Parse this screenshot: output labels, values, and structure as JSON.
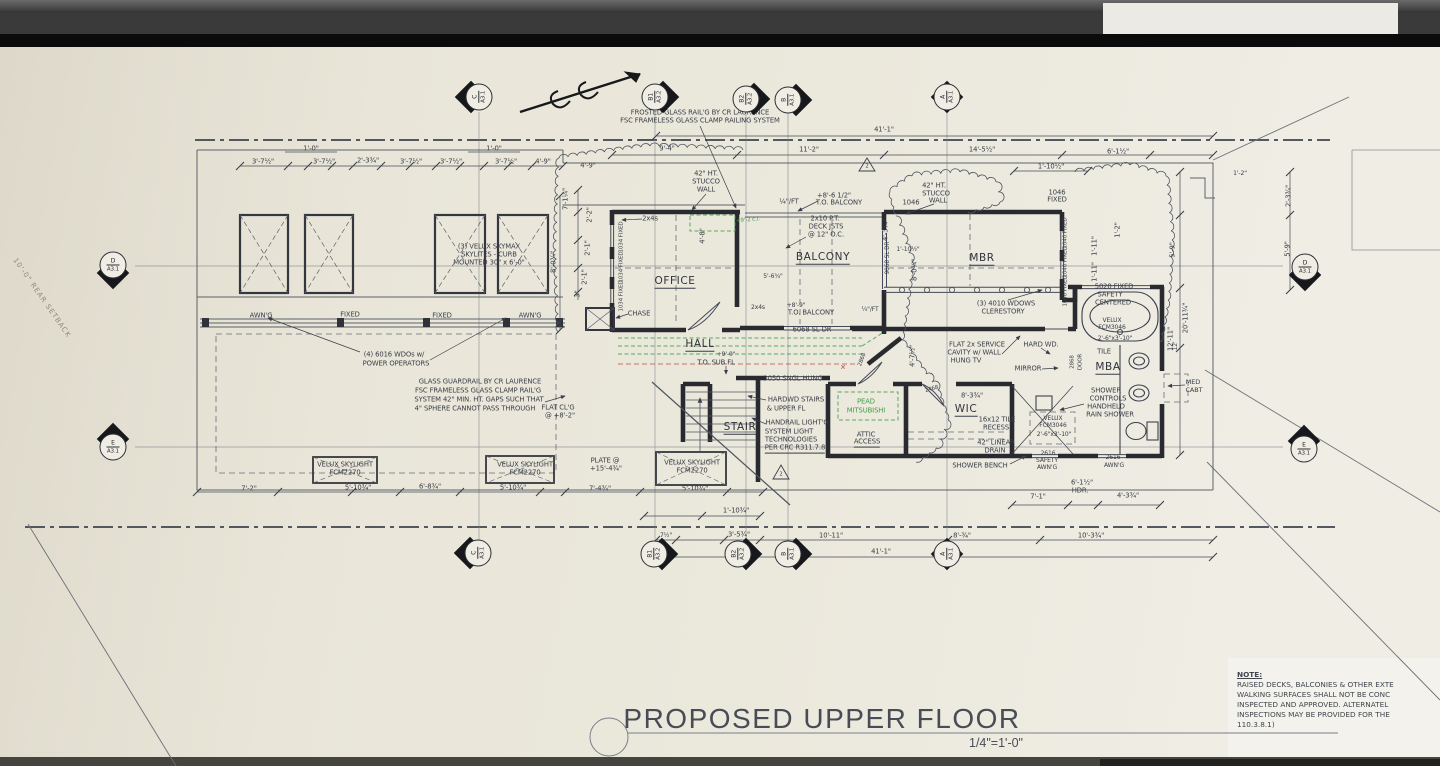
{
  "drawing": {
    "title": "PROPOSED UPPER FLOOR",
    "scale": "1/4\"=1'-0\"",
    "note": {
      "heading": "NOTE:",
      "lines": [
        "RAISED DECKS, BALCONIES & OTHER EXTE",
        "WALKING SURFACES SHALL NOT BE CONC",
        "INSPECTED AND APPROVED. ALTERNATEL",
        "INSPECTIONS MAY BE PROVIDED FOR THE",
        "110.3.8.1)"
      ]
    },
    "setback_label": {
      "t": "10'-0\" REAR SETBACK",
      "x": 42,
      "y": 298,
      "r": 55
    },
    "markers": [
      {
        "id": "C",
        "sheet": "A3.1",
        "x": 479,
        "y": 97,
        "dir": "left"
      },
      {
        "id": "B1",
        "sheet": "A3.2",
        "x": 655,
        "y": 97,
        "dir": "right"
      },
      {
        "id": "B2",
        "sheet": "A3.2",
        "x": 746,
        "y": 99,
        "dir": "right"
      },
      {
        "id": "B",
        "sheet": "A3.1",
        "x": 788,
        "y": 100,
        "dir": "right"
      },
      {
        "id": "A",
        "sheet": "A3.1",
        "x": 947,
        "y": 97,
        "dir": "both"
      },
      {
        "id": "D",
        "sheet": "A3.1",
        "x": 113,
        "y": 265,
        "dir": "down"
      },
      {
        "id": "E",
        "sheet": "A3.1",
        "x": 113,
        "y": 447,
        "dir": "up"
      },
      {
        "id": "D",
        "sheet": "A3.1",
        "x": 1305,
        "y": 267,
        "dir": "down"
      },
      {
        "id": "E",
        "sheet": "A3.1",
        "x": 1304,
        "y": 449,
        "dir": "up"
      },
      {
        "id": "C",
        "sheet": "A3.1",
        "x": 478,
        "y": 553,
        "dir": "left"
      },
      {
        "id": "B1",
        "sheet": "A3.2",
        "x": 654,
        "y": 554,
        "dir": "right"
      },
      {
        "id": "B2",
        "sheet": "A3.2",
        "x": 738,
        "y": 554,
        "dir": "right"
      },
      {
        "id": "B",
        "sheet": "A3.1",
        "x": 788,
        "y": 554,
        "dir": "right"
      },
      {
        "id": "A",
        "sheet": "A3.1",
        "x": 947,
        "y": 554,
        "dir": "both"
      }
    ],
    "labels": [
      {
        "t": "FROSTED GLASS RAIL'G BY CR LAURENCE",
        "x": 700,
        "y": 113
      },
      {
        "t": "FSC FRAMELESS GLASS CLAMP RAILING SYSTEM",
        "x": 700,
        "y": 121
      },
      {
        "t": "41'-1\"",
        "x": 884,
        "y": 130
      },
      {
        "t": "9'-4\"",
        "x": 667,
        "y": 149
      },
      {
        "t": "11'-2\"",
        "x": 809,
        "y": 150
      },
      {
        "t": "14'-5½\"",
        "x": 982,
        "y": 150
      },
      {
        "t": "6'-1½\"",
        "x": 1118,
        "y": 152
      },
      {
        "t": "1'-10½\"",
        "x": 1051,
        "y": 167
      },
      {
        "t": "3'-7½\"",
        "x": 263,
        "y": 162
      },
      {
        "t": "1'-0\"",
        "x": 311,
        "y": 149
      },
      {
        "t": "3'-7½\"",
        "x": 324,
        "y": 162
      },
      {
        "t": "2'-3¾\"",
        "x": 368,
        "y": 161
      },
      {
        "t": "3'-7½\"",
        "x": 411,
        "y": 162
      },
      {
        "t": "3'-7½\"",
        "x": 451,
        "y": 162
      },
      {
        "t": "1'-0\"",
        "x": 494,
        "y": 149
      },
      {
        "t": "3'-7½\"",
        "x": 506,
        "y": 162
      },
      {
        "t": "4'-9\"",
        "x": 543,
        "y": 162
      },
      {
        "t": "4'-9\"",
        "x": 588,
        "y": 166
      },
      {
        "t": "42\" HT.",
        "x": 706,
        "y": 174
      },
      {
        "t": "STUCCO",
        "x": 706,
        "y": 182
      },
      {
        "t": "WALL",
        "x": 706,
        "y": 190
      },
      {
        "t": "+8'-6 1/2\"",
        "x": 834,
        "y": 196
      },
      {
        "t": "T.O. BALCONY",
        "x": 839,
        "y": 203
      },
      {
        "t": "¼\"/FT",
        "x": 789,
        "y": 202
      },
      {
        "t": "2x10 P.T.",
        "x": 825,
        "y": 219
      },
      {
        "t": "DECK JSTS",
        "x": 826,
        "y": 227
      },
      {
        "t": "@ 12\" O.C.",
        "x": 826,
        "y": 235
      },
      {
        "t": "42\" HT.",
        "x": 934,
        "y": 186
      },
      {
        "t": "STUCCO",
        "x": 936,
        "y": 194
      },
      {
        "t": "WALL",
        "x": 938,
        "y": 201
      },
      {
        "t": "1046",
        "x": 911,
        "y": 203
      },
      {
        "t": "2",
        "x": 867,
        "y": 167,
        "fs": 5.2
      },
      {
        "t": "2",
        "x": 781,
        "y": 475,
        "fs": 5.2
      },
      {
        "t": "1046",
        "x": 1057,
        "y": 193
      },
      {
        "t": "FIXED",
        "x": 1057,
        "y": 200
      },
      {
        "t": "2'-3¾\"",
        "x": 1289,
        "y": 196,
        "r": -90
      },
      {
        "t": "5'-9\"",
        "x": 1288,
        "y": 249,
        "r": -90
      },
      {
        "t": "(3) VELUX SKYMAX",
        "x": 489,
        "y": 247
      },
      {
        "t": "SKYLITES - CURB",
        "x": 489,
        "y": 255
      },
      {
        "t": "MOUNTED 30\" x 6'-0\"",
        "x": 489,
        "y": 263
      },
      {
        "t": "7'-1¼\"",
        "x": 566,
        "y": 199,
        "r": -90
      },
      {
        "t": "2'-2\"",
        "x": 590,
        "y": 215,
        "r": -90
      },
      {
        "t": "2'-1\"",
        "x": 588,
        "y": 248,
        "r": -90
      },
      {
        "t": "2'-1\"",
        "x": 585,
        "y": 277,
        "r": -90
      },
      {
        "t": "3\"",
        "x": 578,
        "y": 294,
        "r": -90
      },
      {
        "t": "8'-0¾\"",
        "x": 554,
        "y": 262,
        "r": -90
      },
      {
        "t": "2x4s",
        "x": 650,
        "y": 219
      },
      {
        "t": "1034 FIXED",
        "x": 622,
        "y": 237,
        "r": -90,
        "fs": 5.5
      },
      {
        "t": "1034 FIXED",
        "x": 622,
        "y": 267,
        "r": -90,
        "fs": 5.5
      },
      {
        "t": "1034 FIXED",
        "x": 622,
        "y": 296,
        "r": -90,
        "fs": 5.5
      },
      {
        "t": "4'-8\"",
        "x": 703,
        "y": 236,
        "r": -90
      },
      {
        "t": "OFFICE",
        "x": 675,
        "y": 282,
        "cls": "room u"
      },
      {
        "t": "CHASE",
        "x": 639,
        "y": 314
      },
      {
        "t": "BALCONY",
        "x": 823,
        "y": 258,
        "cls": "room u"
      },
      {
        "t": "MBR",
        "x": 982,
        "y": 259,
        "cls": "room u"
      },
      {
        "t": "9068 SL DR",
        "x": 889,
        "y": 258,
        "r": -90,
        "fs": 5.8
      },
      {
        "t": "1'-10½\"",
        "x": 908,
        "y": 250,
        "fs": 6
      },
      {
        "t": "8'-0¾\"",
        "x": 915,
        "y": 270,
        "r": -90
      },
      {
        "t": "5'-6¾\"",
        "x": 773,
        "y": 277,
        "fs": 6
      },
      {
        "t": "1040 FIXED",
        "x": 1066,
        "y": 233,
        "r": -90,
        "fs": 5.5
      },
      {
        "t": "1040 FIXED",
        "x": 1066,
        "y": 262,
        "r": -90,
        "fs": 5.5
      },
      {
        "t": "1040 FIXED",
        "x": 1066,
        "y": 291,
        "r": -90,
        "fs": 5.5
      },
      {
        "t": "1'-11\"",
        "x": 1095,
        "y": 246,
        "r": -90
      },
      {
        "t": "1'-11\"",
        "x": 1095,
        "y": 272,
        "r": -90
      },
      {
        "t": "1'-2\"",
        "x": 1118,
        "y": 230,
        "r": -90
      },
      {
        "t": "1'-2\"",
        "x": 1240,
        "y": 174,
        "fs": 6
      },
      {
        "t": "(3) 4010 WDOWS",
        "x": 1006,
        "y": 304
      },
      {
        "t": "CLERESTORY",
        "x": 1003,
        "y": 312
      },
      {
        "t": "5020 FIXED",
        "x": 1114,
        "y": 287
      },
      {
        "t": "SAFETY",
        "x": 1110,
        "y": 295
      },
      {
        "t": "CENTERED",
        "x": 1113,
        "y": 303
      },
      {
        "t": "VELUX",
        "x": 1112,
        "y": 321,
        "fs": 6
      },
      {
        "t": "FCM3046",
        "x": 1112,
        "y": 328,
        "fs": 6
      },
      {
        "t": "2'-6\"x3'-10\"",
        "x": 1115,
        "y": 339,
        "fs": 6
      },
      {
        "t": "FLAT 2x SERVICE",
        "x": 977,
        "y": 345
      },
      {
        "t": "CAVITY w/ WALL",
        "x": 974,
        "y": 353
      },
      {
        "t": "HUNG TV",
        "x": 966,
        "y": 361
      },
      {
        "t": "HARD WD.",
        "x": 1041,
        "y": 345
      },
      {
        "t": "TILE",
        "x": 1104,
        "y": 352
      },
      {
        "t": "MIRROR",
        "x": 1028,
        "y": 369
      },
      {
        "t": "2868",
        "x": 1073,
        "y": 362,
        "r": -90,
        "fs": 5.5
      },
      {
        "t": "DOOR",
        "x": 1081,
        "y": 362,
        "r": -90,
        "fs": 5.5
      },
      {
        "t": "MBA",
        "x": 1108,
        "y": 368,
        "cls": "room u"
      },
      {
        "t": "MED",
        "x": 1193,
        "y": 382,
        "fs": 6.5
      },
      {
        "t": "CABT",
        "x": 1194,
        "y": 390,
        "fs": 6.5
      },
      {
        "t": "WIC",
        "x": 966,
        "y": 410,
        "cls": "room u"
      },
      {
        "t": "8'-3¾\"",
        "x": 972,
        "y": 396
      },
      {
        "t": "16x12 TILE",
        "x": 997,
        "y": 420
      },
      {
        "t": "RECESS",
        "x": 996,
        "y": 428
      },
      {
        "t": "42\" LINEAR",
        "x": 996,
        "y": 443
      },
      {
        "t": "DRAIN",
        "x": 995,
        "y": 451
      },
      {
        "t": "SHOWER",
        "x": 1106,
        "y": 391
      },
      {
        "t": "CONTROLS",
        "x": 1108,
        "y": 399
      },
      {
        "t": "HANDHELD",
        "x": 1106,
        "y": 407
      },
      {
        "t": "RAIN SHOWER",
        "x": 1110,
        "y": 415
      },
      {
        "t": "VELUX",
        "x": 1053,
        "y": 419,
        "fs": 6
      },
      {
        "t": "FCM3046",
        "x": 1053,
        "y": 426,
        "fs": 6
      },
      {
        "t": "2'-6\"x3'-10\"",
        "x": 1054,
        "y": 435,
        "fs": 6
      },
      {
        "t": "SHOWER BENCH",
        "x": 980,
        "y": 466
      },
      {
        "t": "2616",
        "x": 1048,
        "y": 454,
        "fs": 6
      },
      {
        "t": "SAFETY",
        "x": 1047,
        "y": 461,
        "fs": 6
      },
      {
        "t": "AWN'G",
        "x": 1047,
        "y": 468,
        "fs": 6
      },
      {
        "t": "2616",
        "x": 1113,
        "y": 458,
        "fs": 6
      },
      {
        "t": "AWN'G",
        "x": 1114,
        "y": 466,
        "fs": 6
      },
      {
        "t": "6'-1½\"",
        "x": 1082,
        "y": 483
      },
      {
        "t": "HDR.",
        "x": 1080,
        "y": 491
      },
      {
        "t": "12'",
        "x": 1176,
        "y": 346,
        "r": -90,
        "fs": 6
      },
      {
        "t": "5'-9\"",
        "x": 1173,
        "y": 250,
        "r": -90
      },
      {
        "t": "20'-11¾\"",
        "x": 1186,
        "y": 318,
        "r": -90
      },
      {
        "t": "12'-11\"",
        "x": 1171,
        "y": 339,
        "r": -90
      },
      {
        "t": "HALL",
        "x": 700,
        "y": 345,
        "cls": "room u"
      },
      {
        "t": "+9'-0\"",
        "x": 726,
        "y": 355,
        "fs": 6
      },
      {
        "t": "T.O. SUB FL",
        "x": 716,
        "y": 363
      },
      {
        "t": "+8'-9\"",
        "x": 796,
        "y": 306,
        "fs": 6
      },
      {
        "t": "T.O. BALCONY",
        "x": 811,
        "y": 313
      },
      {
        "t": "6068 SL DR",
        "x": 812,
        "y": 330
      },
      {
        "t": "2x4s",
        "x": 758,
        "y": 308,
        "fs": 6
      },
      {
        "t": "3050 SNGL HUNG",
        "x": 793,
        "y": 379
      },
      {
        "t": "2868",
        "x": 863,
        "y": 360,
        "r": -70,
        "fs": 5.5
      },
      {
        "t": "2468",
        "x": 932,
        "y": 390,
        "r": -15,
        "fs": 5.5
      },
      {
        "t": "¼\"/FT",
        "x": 870,
        "y": 310,
        "fs": 6
      },
      {
        "t": "4'-7½\"",
        "x": 913,
        "y": 356,
        "r": -90
      },
      {
        "t": "4'-3¾\"",
        "x": 886,
        "y": 230,
        "r": -90
      },
      {
        "t": "STAIR",
        "x": 740,
        "y": 428,
        "cls": "room u"
      },
      {
        "t": "HARDWD STAIRS",
        "x": 796,
        "y": 400
      },
      {
        "t": "& UPPER FL",
        "x": 786,
        "y": 409
      },
      {
        "t": "HANDRAIL LIGHT'G",
        "x": 797,
        "y": 423
      },
      {
        "t": "SYSTEM LIGHT",
        "x": 789,
        "y": 432
      },
      {
        "t": "TECHNOLOGIES",
        "x": 791,
        "y": 440
      },
      {
        "t": "PER CRC R311.7.8",
        "x": 795,
        "y": 449,
        "cls": "u"
      },
      {
        "t": "PEAD",
        "x": 866,
        "y": 402,
        "cls": "g"
      },
      {
        "t": "MITSUBISHI",
        "x": 866,
        "y": 411,
        "cls": "g"
      },
      {
        "t": "ATTIC",
        "x": 866,
        "y": 435
      },
      {
        "t": "ACCESS",
        "x": 867,
        "y": 443,
        "cls": "u"
      },
      {
        "t": "✕",
        "x": 843,
        "y": 368,
        "cls": "rd",
        "fs": 7
      },
      {
        "t": "+9'-2 c.l.",
        "x": 748,
        "y": 221,
        "cls": "g",
        "fs": 5.5,
        "r": -5
      },
      {
        "t": "AWN'G",
        "x": 261,
        "y": 316
      },
      {
        "t": "FIXED",
        "x": 350,
        "y": 315
      },
      {
        "t": "FIXED",
        "x": 442,
        "y": 316
      },
      {
        "t": "AWN'G",
        "x": 530,
        "y": 316
      },
      {
        "t": "(4) 6016 WDOs w/",
        "x": 394,
        "y": 355
      },
      {
        "t": "POWER OPERATORS",
        "x": 396,
        "y": 364
      },
      {
        "t": "GLASS GUARDRAIL BY CR LAURENCE",
        "x": 480,
        "y": 382
      },
      {
        "t": "FSC FRAMELESS GLASS CLAMP RAIL'G",
        "x": 478,
        "y": 391
      },
      {
        "t": "SYSTEM 42\" MIN. HT. GAPS SUCH THAT",
        "x": 479,
        "y": 400
      },
      {
        "t": "4\" SPHERE CANNOT PASS THROUGH",
        "x": 475,
        "y": 409
      },
      {
        "t": "VELUX SKYLIGHT",
        "x": 345,
        "y": 465
      },
      {
        "t": "FCM2270",
        "x": 345,
        "y": 473
      },
      {
        "t": "VELUX SKYLIGHT",
        "x": 525,
        "y": 465
      },
      {
        "t": "FCM2270",
        "x": 525,
        "y": 473
      },
      {
        "t": "VELUX SKYLIGHT",
        "x": 692,
        "y": 463
      },
      {
        "t": "FCM2270",
        "x": 692,
        "y": 471
      },
      {
        "t": "FLAT CL'G",
        "x": 558,
        "y": 408
      },
      {
        "t": "@ +8'-2\"",
        "x": 560,
        "y": 416
      },
      {
        "t": "PLATE @",
        "x": 605,
        "y": 461
      },
      {
        "t": "+15'-4¾\"",
        "x": 606,
        "y": 469
      },
      {
        "t": "7'-2\"",
        "x": 249,
        "y": 489
      },
      {
        "t": "5'-10¾\"",
        "x": 358,
        "y": 488
      },
      {
        "t": "6'-8¾\"",
        "x": 430,
        "y": 487
      },
      {
        "t": "5'-10¾\"",
        "x": 513,
        "y": 488
      },
      {
        "t": "7'-4¾\"",
        "x": 600,
        "y": 489
      },
      {
        "t": "5'-10¾\"",
        "x": 695,
        "y": 489
      },
      {
        "t": "1'-10¾\"",
        "x": 736,
        "y": 511
      },
      {
        "t": "7½\"",
        "x": 666,
        "y": 536,
        "fs": 6
      },
      {
        "t": "3'-5¾\"",
        "x": 739,
        "y": 535
      },
      {
        "t": "10'-11\"",
        "x": 831,
        "y": 536
      },
      {
        "t": "41'-1\"",
        "x": 881,
        "y": 552
      },
      {
        "t": "8'-¾\"",
        "x": 962,
        "y": 536
      },
      {
        "t": "10'-3¾\"",
        "x": 1091,
        "y": 536
      },
      {
        "t": "7'-1\"",
        "x": 1038,
        "y": 497
      },
      {
        "t": "4'-3¾\"",
        "x": 1128,
        "y": 496
      }
    ]
  }
}
